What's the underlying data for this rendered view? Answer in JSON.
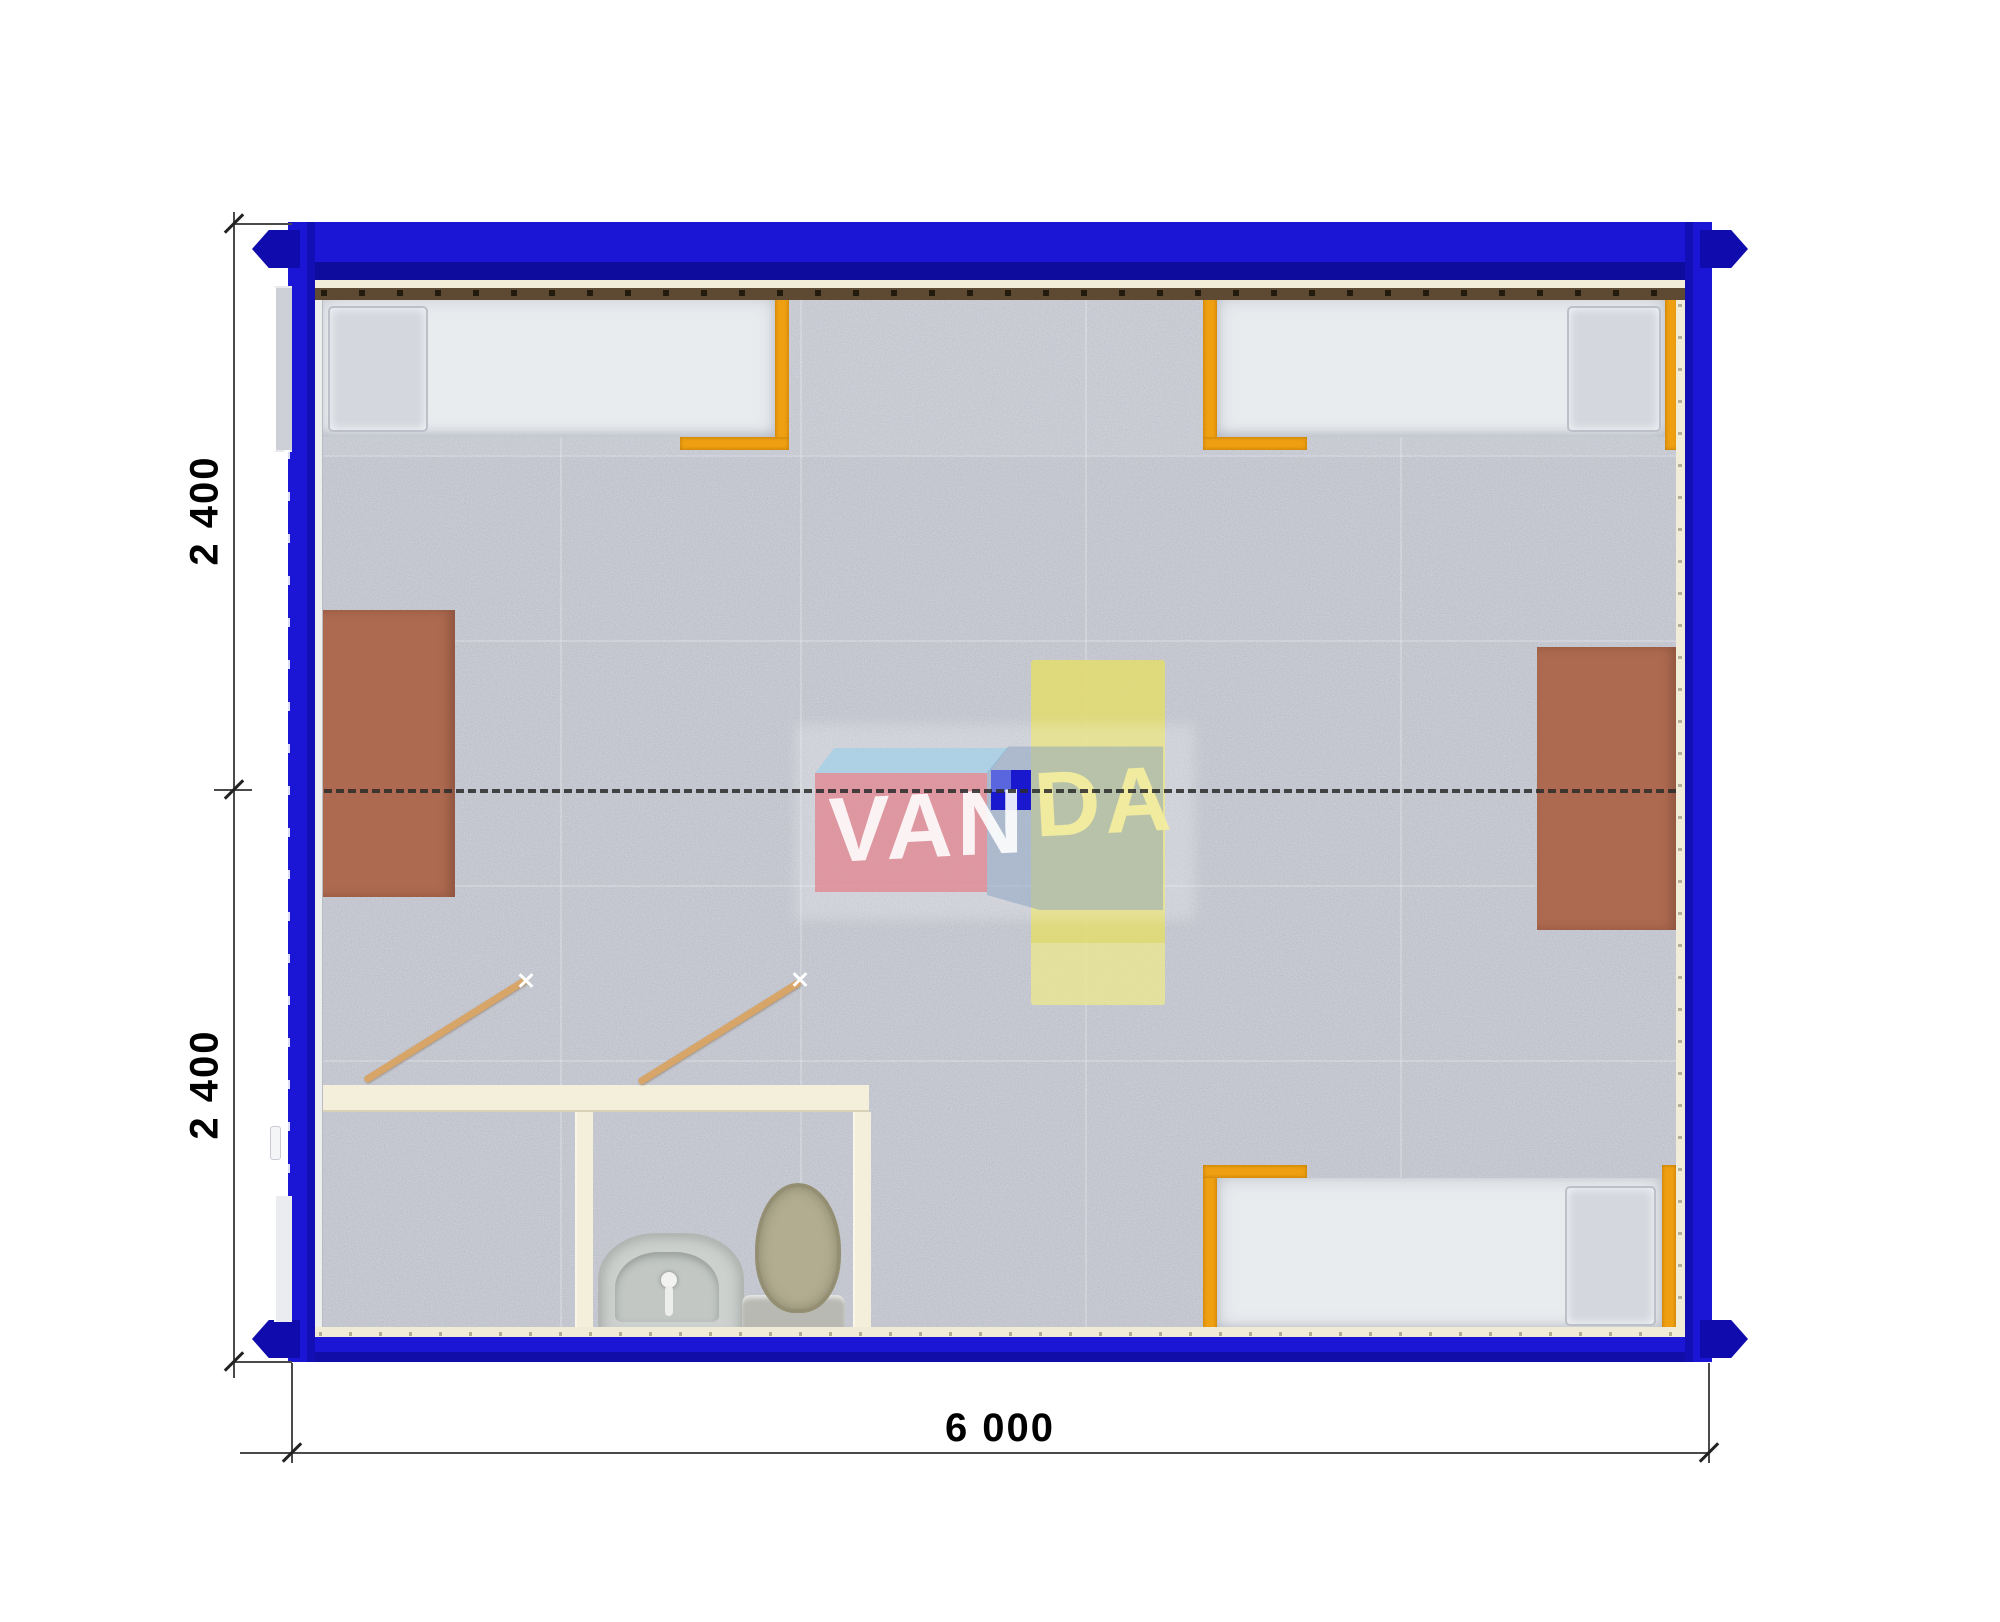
{
  "drawing": {
    "kind": "container-building-floor-plan",
    "dimensions": {
      "bottom_width_label": "6 000",
      "left_upper_height_label": "2 400",
      "left_lower_height_label": "2 400"
    },
    "watermark": {
      "brand": "VANDA",
      "left_text": "VAN",
      "right_text": "DA"
    },
    "colors": {
      "frame_blue": "#1711c9",
      "corner_casting_blue": "#0f0bad",
      "floor_gray": "#b5b8c2",
      "wall_liner_cream": "#f2edd9",
      "top_rail_brown": "#5e4a33",
      "bed_frame_orange": "#efa011",
      "mattress_white": "#e9ecef",
      "desk_brown": "#ad6a50",
      "center_table_yellow": "#e2dc70",
      "bathroom_wall_cream": "#f4efda",
      "door_leaf_tan": "#d8a568",
      "logo_pink": "#e08a94",
      "logo_light_blue": "#a5d0e6",
      "logo_solid_blue": "#1a18cf"
    },
    "furniture": [
      {
        "name": "bed-top-left"
      },
      {
        "name": "bed-top-right"
      },
      {
        "name": "bed-bottom-right"
      },
      {
        "name": "desk-left"
      },
      {
        "name": "desk-right"
      },
      {
        "name": "center-table-yellow"
      },
      {
        "name": "bathroom-left-room"
      },
      {
        "name": "bathroom-right-room"
      },
      {
        "name": "toilet"
      },
      {
        "name": "washbasin"
      }
    ]
  }
}
